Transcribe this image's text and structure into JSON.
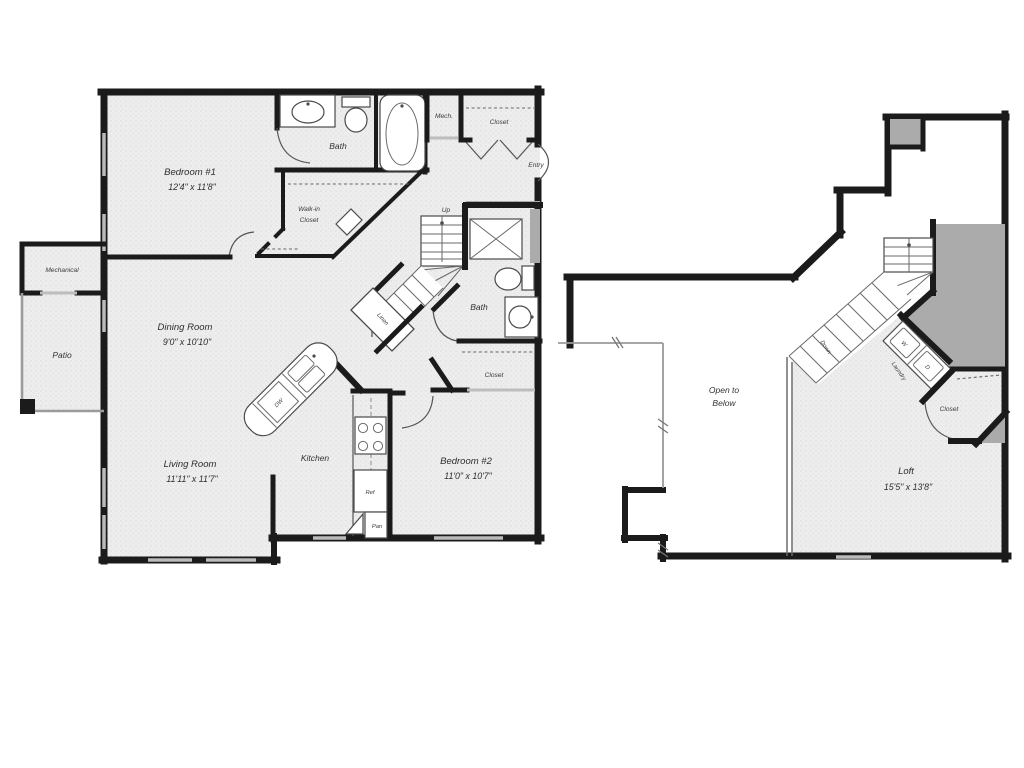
{
  "floor1": {
    "bedroom1_name": "Bedroom #1",
    "bedroom1_dims": "12'4\" x 11'8\"",
    "bath1": "Bath",
    "mech": "Mech.",
    "entry_closet": "Closet",
    "entry": "Entry",
    "walkin_line1": "Walk-in",
    "walkin_line2": "Closet",
    "dining_name": "Dining Room",
    "dining_dims": "9'0\" x 10'10\"",
    "mechanical": "Mechanical",
    "patio": "Patio",
    "up": "Up",
    "linen": "Linen",
    "bath2": "Bath",
    "bedroom2_closet": "Closet",
    "living_name": "Living Room",
    "living_dims": "11'11\" x 11'7\"",
    "kitchen": "Kitchen",
    "dw": "DW",
    "ref": "Ref",
    "pan": "Pan",
    "bedroom2_name": "Bedroom #2",
    "bedroom2_dims": "11'0\" x 10'7\""
  },
  "floor2": {
    "open_line1": "Open to",
    "open_line2": "Below",
    "down": "Down",
    "laundry": "Laundry",
    "washer": "W",
    "dryer": "D",
    "closet": "Closet",
    "loft_name": "Loft",
    "loft_dims": "15'5\" x 13'8\""
  },
  "colors": {
    "wall": "#1b1b1b",
    "shaded_area": "#ababab",
    "window": "#bbbbbb",
    "floor_tint": "#ededed"
  }
}
